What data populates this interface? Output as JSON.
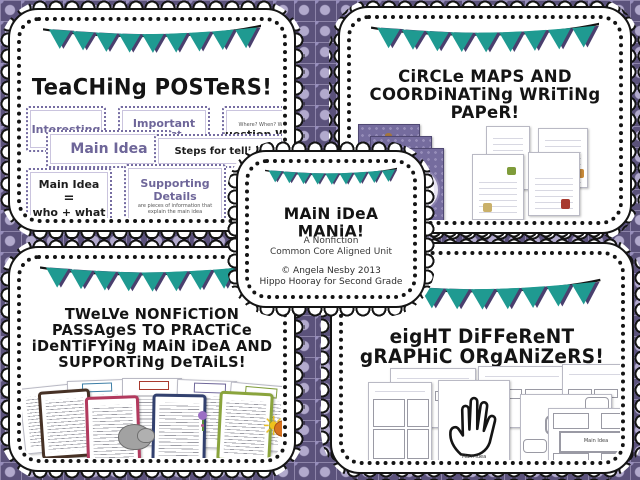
{
  "colors": {
    "background_base": "#5b527b",
    "background_grid": "#8e85aa",
    "background_dot": "#b2aacd",
    "flag_teal": "#1f9a91",
    "flag_shadow": "#4a3f6e",
    "ink": "#141414",
    "poster_purple": "#6e6699"
  },
  "center_card": {
    "title": "MAiN iDeA MANiA!",
    "subtitle_lines": [
      "A Nonfiction",
      "Common Core Aligned Unit"
    ],
    "credit_lines": [
      "© Angela Nesby 2013",
      "Hippo Hooray for Second Grade"
    ]
  },
  "teaching_card": {
    "title": "TeaCHiNg POSTeRS!",
    "minis": {
      "interesting": "Interesting",
      "important": "Important",
      "important_sub": "Informat…",
      "important_tiny": "facts that…",
      "question_tiny": "Where?  When?  Who?",
      "question": "Question Words",
      "main_idea": "Main Idea",
      "steps": "Steps for telling",
      "equation_line1": "Main Idea",
      "equation_line2": "=",
      "equation_line3": "who + what",
      "supporting_line1": "Supporting",
      "supporting_line2": "Details",
      "supporting_sub": "are pieces of information that explain the main idea",
      "main_partial": "Main"
    }
  },
  "circle_card": {
    "title_lines": [
      "CiRCLe MAPS AND",
      "COORDiNATiNg WRiTiNg",
      "PAPeR!"
    ]
  },
  "passages_card": {
    "title_lines": [
      "TWeLVe NONFiCTiON",
      "PASSAgeS TO PRACTiCe",
      "iDeNTiFYiNg MAiN iDeA AND",
      "SUPPORTiNg DeTAiLS!"
    ]
  },
  "organizers_card": {
    "title_lines": [
      "eigHT DiFFeReNT",
      "gRAPHiC ORgANiZeRS!"
    ],
    "hand_label": "Main Idea",
    "bubble_label": "Main Idea",
    "grid_label": "Main Idea"
  }
}
